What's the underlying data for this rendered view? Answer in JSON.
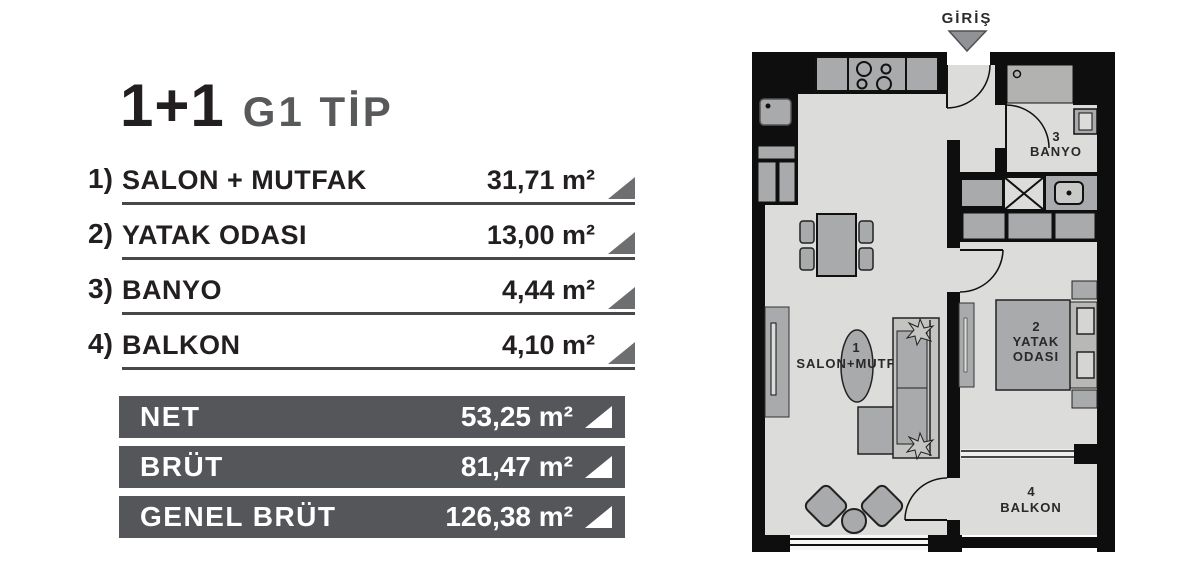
{
  "title": {
    "type": "1+1",
    "variant": "G1 TİP"
  },
  "rooms": [
    {
      "num": "1)",
      "label": "SALON + MUTFAK",
      "area": "31,71 m²"
    },
    {
      "num": "2)",
      "label": "YATAK ODASI",
      "area": "13,00 m²"
    },
    {
      "num": "3)",
      "label": "BANYO",
      "area": "4,44 m²"
    },
    {
      "num": "4)",
      "label": "BALKON",
      "area": "4,10 m²"
    }
  ],
  "totals": [
    {
      "label": "NET",
      "area": "53,25 m²"
    },
    {
      "label": "BRÜT",
      "area": "81,47 m²"
    },
    {
      "label": "GENEL BRÜT",
      "area": "126,38 m²"
    }
  ],
  "floorplan": {
    "entrance_label": "GİRİŞ",
    "rooms": {
      "salon": {
        "num": "1",
        "name": "SALON+MUTFAK"
      },
      "bedroom": {
        "num": "2",
        "name_line1": "YATAK",
        "name_line2": "ODASI"
      },
      "bathroom": {
        "num": "3",
        "name": "BANYO"
      },
      "balcony": {
        "num": "4",
        "name": "BALKON"
      }
    }
  },
  "colors": {
    "bar_background": "#54565a",
    "list_triangle": "#6d6e70",
    "bar_triangle": "#ffffff",
    "underline": "#48484a",
    "title_accent": "#231f20",
    "title_variant": "#58595b",
    "plan_wall": "#0e0e0e",
    "plan_floor": "#dcdcda",
    "plan_furniture": "#a9aaac",
    "entrance_arrow": "#909295"
  }
}
